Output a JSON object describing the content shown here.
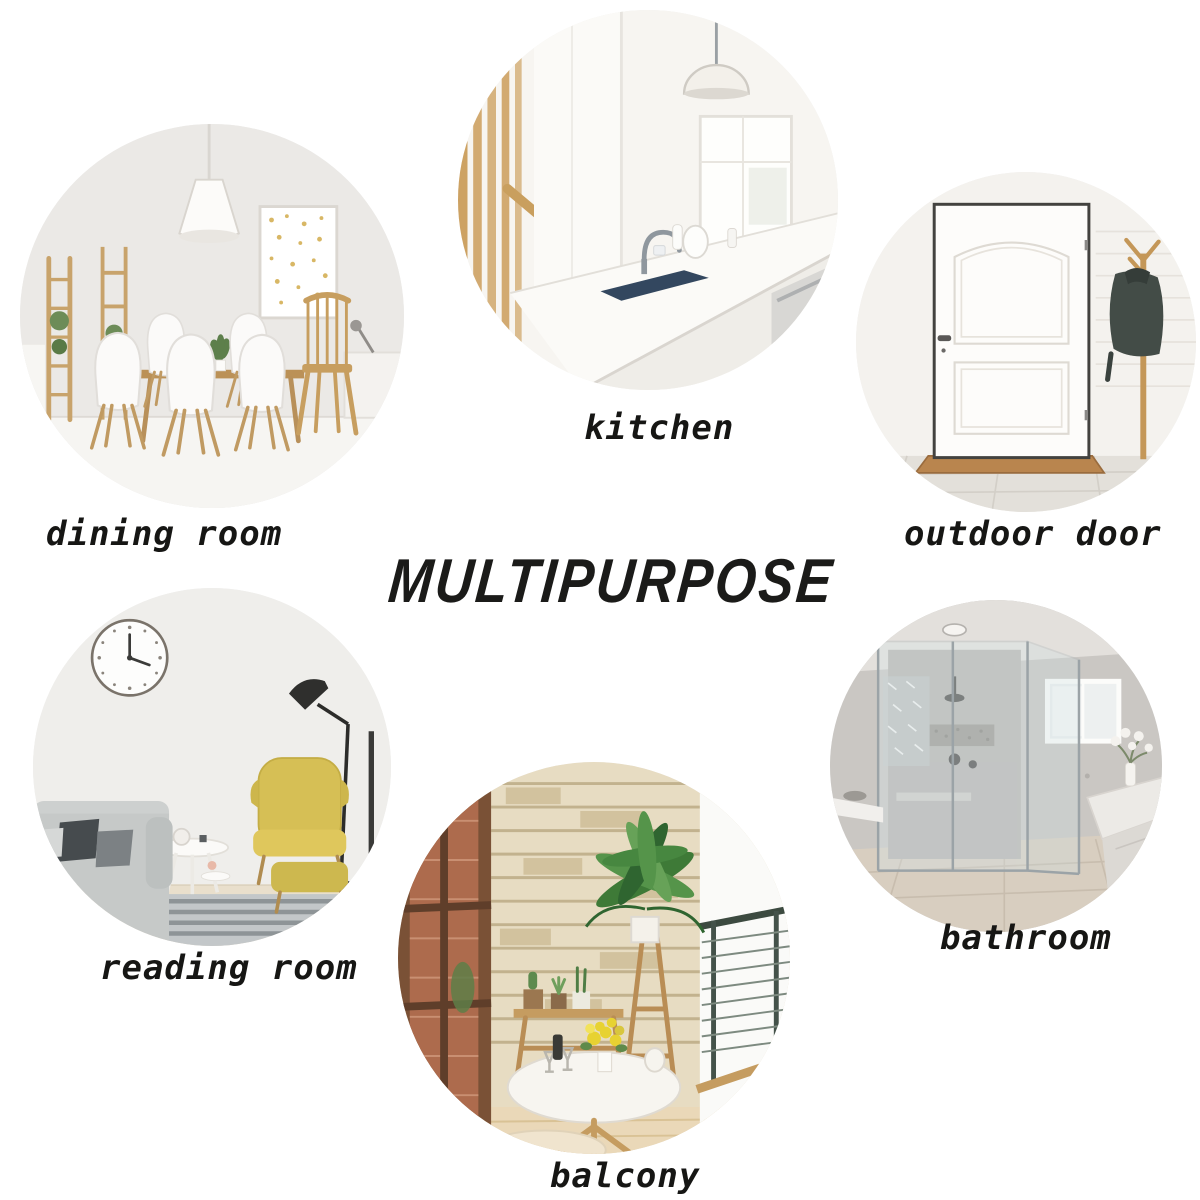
{
  "title": "MULTIPURPOSE",
  "rooms": [
    {
      "id": "dining-room",
      "label": "dining room"
    },
    {
      "id": "kitchen",
      "label": "kitchen"
    },
    {
      "id": "outdoor-door",
      "label": "outdoor door"
    },
    {
      "id": "reading-room",
      "label": "reading room"
    },
    {
      "id": "bathroom",
      "label": "bathroom"
    },
    {
      "id": "balcony",
      "label": "balcony"
    }
  ],
  "colors": {
    "background": "#ffffff",
    "title_text": "#1b1b19",
    "label_text": "#161614",
    "wood_accent": "#c49a5e",
    "chair_yellow": "#d6bf55",
    "sink_navy": "#33475f",
    "jacket_gray": "#434c47"
  }
}
